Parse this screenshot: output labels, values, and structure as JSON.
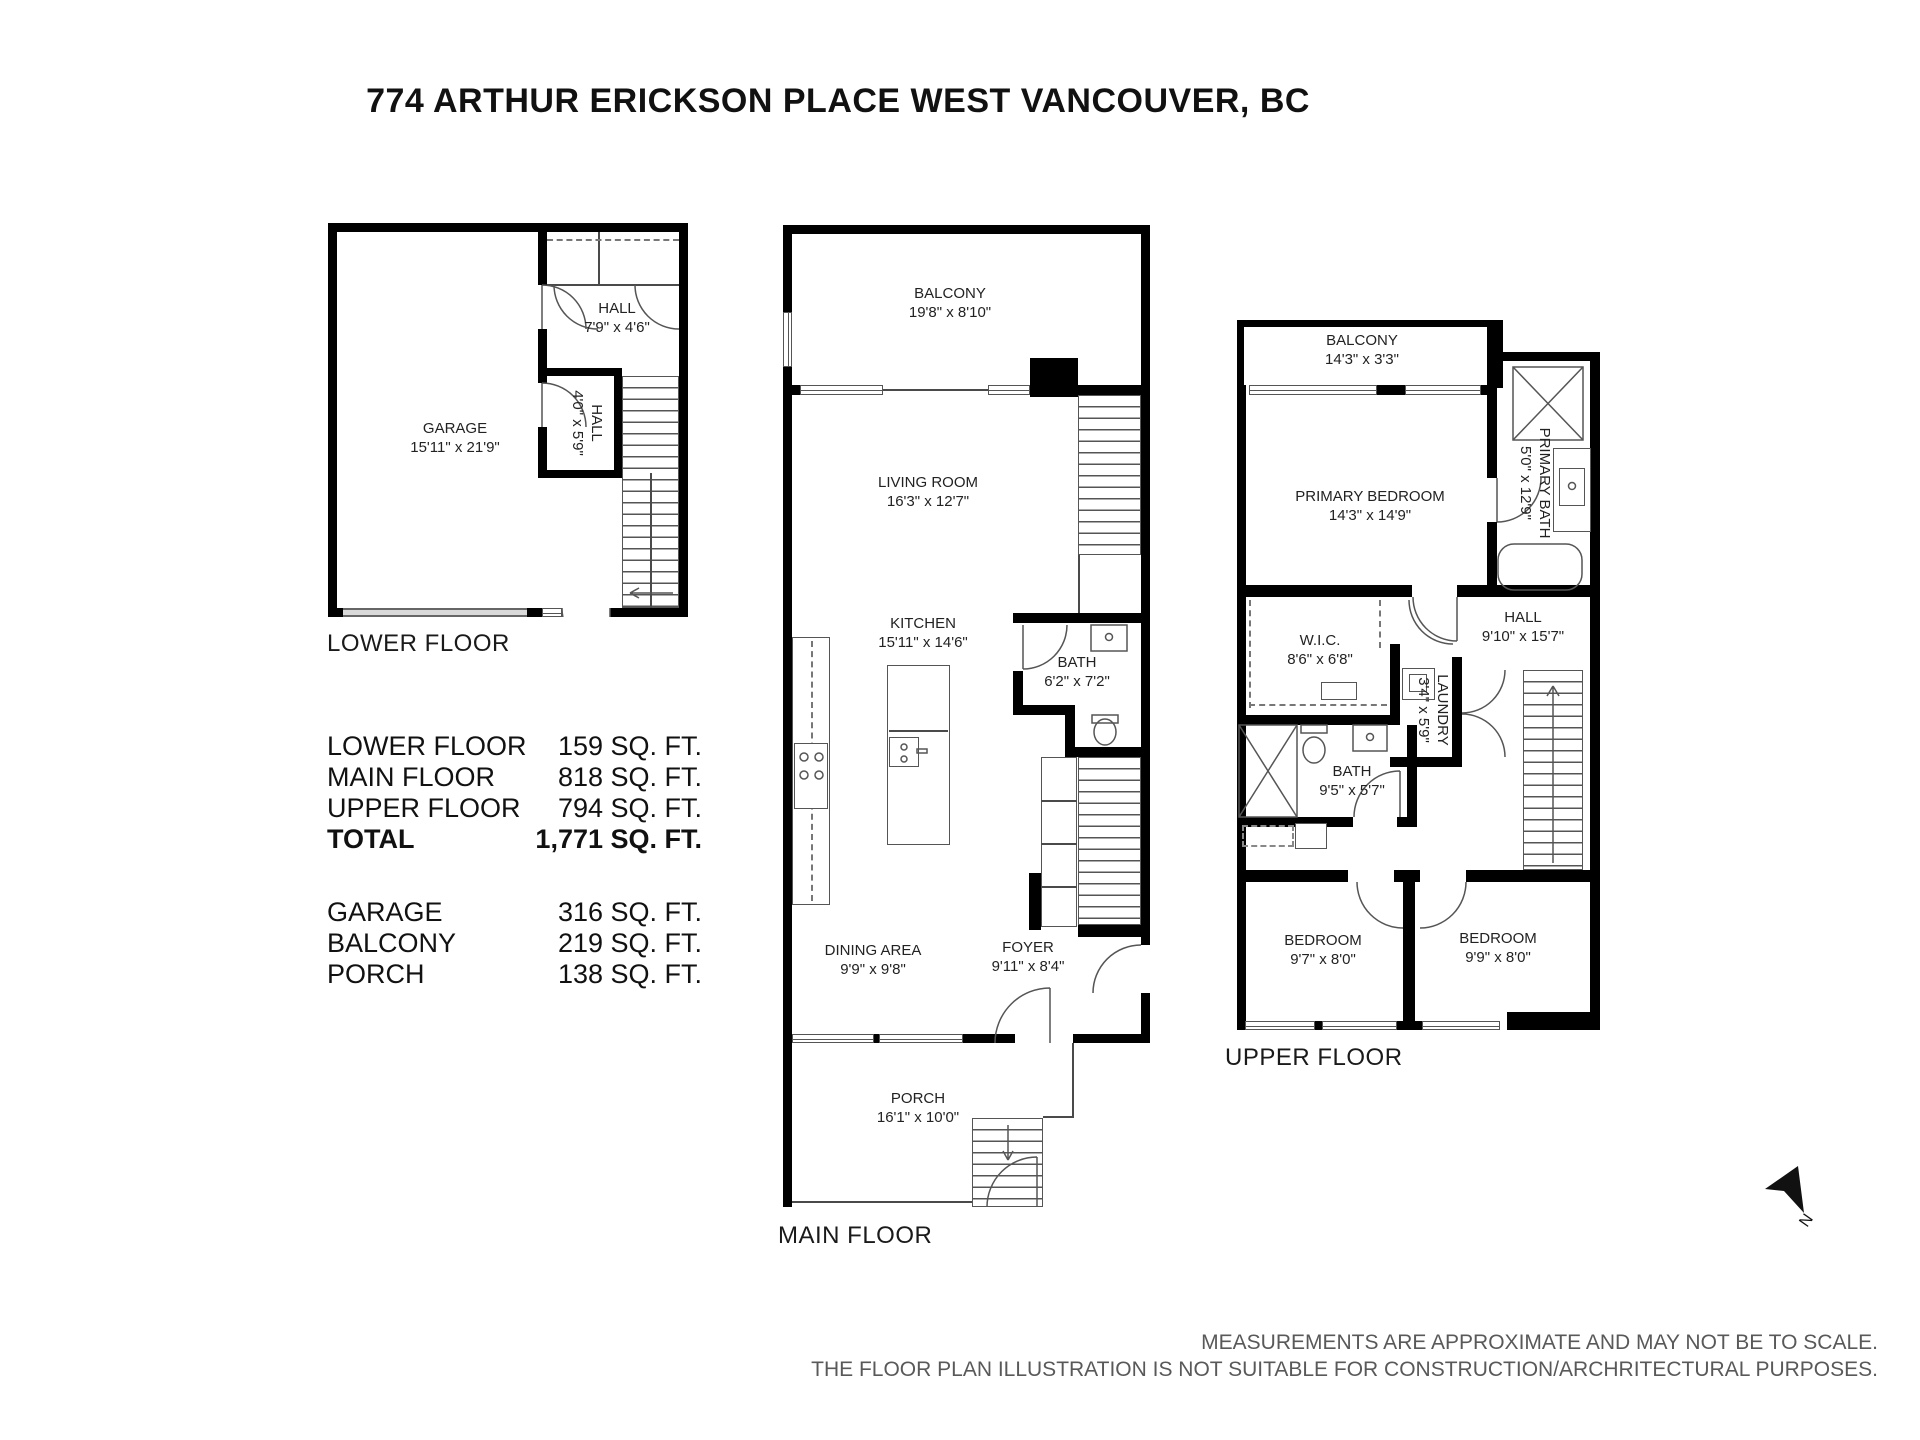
{
  "title": "774 ARTHUR ERICKSON PLACE WEST VANCOUVER, BC",
  "floors": {
    "lower": {
      "label": "LOWER FLOOR",
      "rooms": {
        "garage": {
          "name": "GARAGE",
          "dims": "15'11\" x 21'9\""
        },
        "hall_upper": {
          "name": "HALL",
          "dims": "7'9\" x 4'6\""
        },
        "hall_lower": {
          "name": "HALL",
          "dims": "4'0\" x 5'9\""
        }
      }
    },
    "main": {
      "label": "MAIN FLOOR",
      "rooms": {
        "balcony": {
          "name": "BALCONY",
          "dims": "19'8\" x 8'10\""
        },
        "living_room": {
          "name": "LIVING ROOM",
          "dims": "16'3\" x 12'7\""
        },
        "kitchen": {
          "name": "KITCHEN",
          "dims": "15'11\" x 14'6\""
        },
        "bath": {
          "name": "BATH",
          "dims": "6'2\" x 7'2\""
        },
        "dining_area": {
          "name": "DINING AREA",
          "dims": "9'9\" x 9'8\""
        },
        "foyer": {
          "name": "FOYER",
          "dims": "9'11\" x 8'4\""
        },
        "porch": {
          "name": "PORCH",
          "dims": "16'1\" x 10'0\""
        }
      }
    },
    "upper": {
      "label": "UPPER FLOOR",
      "rooms": {
        "balcony": {
          "name": "BALCONY",
          "dims": "14'3\" x 3'3\""
        },
        "primary_bedroom": {
          "name": "PRIMARY BEDROOM",
          "dims": "14'3\" x 14'9\""
        },
        "primary_bath": {
          "name": "PRIMARY BATH",
          "dims": "5'0\" x 12'9\""
        },
        "wic": {
          "name": "W.I.C.",
          "dims": "8'6\" x 6'8\""
        },
        "hall": {
          "name": "HALL",
          "dims": "9'10\" x 15'7\""
        },
        "laundry": {
          "name": "LAUNDRY",
          "dims": "3'4\" x 5'9\""
        },
        "bath": {
          "name": "BATH",
          "dims": "9'5\" x 5'7\""
        },
        "bedroom_left": {
          "name": "BEDROOM",
          "dims": "9'7\" x 8'0\""
        },
        "bedroom_right": {
          "name": "BEDROOM",
          "dims": "9'9\" x 8'0\""
        }
      }
    }
  },
  "area_table": {
    "floor_rows": [
      {
        "label": "LOWER FLOOR",
        "value": "159 SQ. FT."
      },
      {
        "label": "MAIN FLOOR",
        "value": "818 SQ. FT."
      },
      {
        "label": "UPPER FLOOR",
        "value": "794 SQ. FT."
      },
      {
        "label": "TOTAL",
        "value": "1,771 SQ. FT."
      }
    ],
    "other_rows": [
      {
        "label": "GARAGE",
        "value": "316 SQ. FT."
      },
      {
        "label": "BALCONY",
        "value": "219 SQ. FT."
      },
      {
        "label": "PORCH",
        "value": "138 SQ. FT."
      }
    ]
  },
  "compass": {
    "north_label": "N"
  },
  "disclaimer": {
    "line1": "MEASUREMENTS ARE APPROXIMATE AND MAY NOT BE TO SCALE.",
    "line2": "THE FLOOR PLAN ILLUSTRATION IS NOT SUITABLE FOR CONSTRUCTION/ARCHRITECTURAL PURPOSES."
  }
}
